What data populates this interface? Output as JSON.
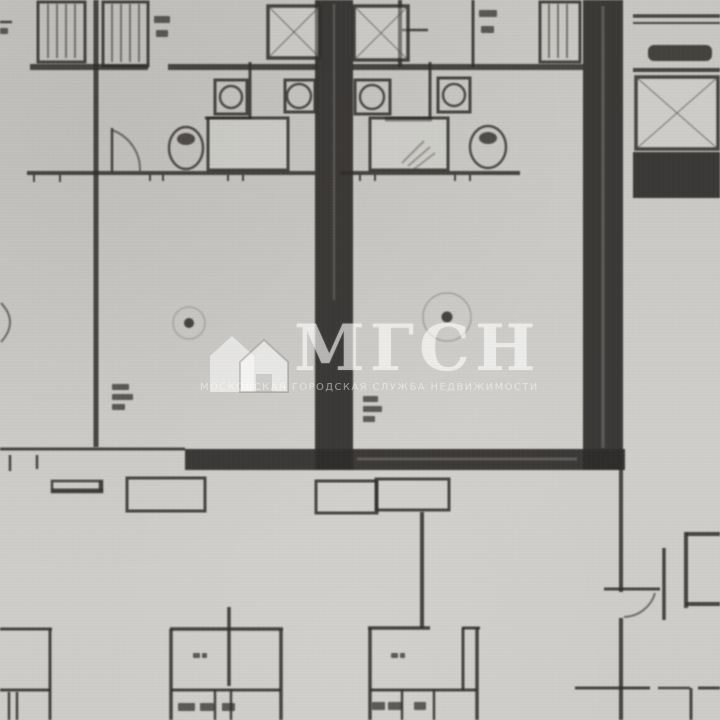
{
  "watermark": {
    "logo_text": "МГСН",
    "subtitle": "МОСКОВСКАЯ ГОРОДСКАЯ СЛУЖБА НЕДВИЖИМОСТИ",
    "color": "#ffffff",
    "opacity": 0.55,
    "icon": "house-icon"
  },
  "palette": {
    "paper": "#cbcac6",
    "paper_light": "#d6d5d1",
    "ink": "#2f2d2a",
    "ink_soft": "#45433f",
    "dark_mass": "#35332f"
  },
  "plan": {
    "thick_walls": [
      [
        315,
        0,
        38,
        470
      ],
      [
        185,
        449,
        440,
        21
      ],
      [
        583,
        0,
        40,
        470
      ],
      [
        633,
        152,
        87,
        46
      ]
    ],
    "dark_fills": [
      [
        648,
        45,
        64,
        16,
        6
      ]
    ],
    "thin_lines": [
      [
        96,
        0,
        96,
        447,
        5
      ],
      [
        250,
        62,
        250,
        118,
        3
      ],
      [
        430,
        62,
        430,
        119,
        3
      ],
      [
        400,
        0,
        400,
        67,
        4
      ],
      [
        473,
        0,
        473,
        67,
        3
      ],
      [
        422,
        512,
        422,
        628,
        4
      ],
      [
        229,
        607,
        229,
        686,
        3.5
      ],
      [
        621,
        470,
        621,
        592,
        4
      ],
      [
        621,
        618,
        621,
        720,
        4
      ],
      [
        664,
        548,
        664,
        620,
        3.5
      ],
      [
        686,
        532,
        686,
        608,
        4
      ],
      [
        50,
        629,
        50,
        720,
        3
      ],
      [
        171,
        629,
        171,
        720,
        3.5
      ],
      [
        281,
        629,
        281,
        720,
        3.5
      ],
      [
        370,
        628,
        370,
        720,
        3.5
      ],
      [
        477,
        628,
        477,
        720,
        3.5
      ],
      [
        463,
        628,
        463,
        690,
        3
      ],
      [
        402,
        690,
        402,
        720,
        2.5
      ],
      [
        434,
        690,
        434,
        720,
        2.5
      ],
      [
        215,
        690,
        215,
        720,
        2.5
      ],
      [
        231,
        690,
        231,
        720,
        2.5
      ],
      [
        9,
        692,
        9,
        720,
        2.5
      ],
      [
        17,
        692,
        17,
        720,
        2.5
      ],
      [
        691,
        688,
        691,
        720,
        3
      ],
      [
        10,
        455,
        10,
        471,
        2.5
      ],
      [
        37,
        455,
        37,
        469,
        2.5
      ],
      [
        112,
        128,
        112,
        172,
        2.5
      ],
      [
        100,
        481,
        100,
        490,
        2.5
      ],
      [
        34,
        175,
        34,
        182,
        2
      ],
      [
        60,
        175,
        60,
        182,
        2
      ],
      [
        150,
        175,
        150,
        181,
        2
      ],
      [
        163,
        175,
        163,
        181,
        2
      ],
      [
        228,
        175,
        228,
        181,
        2
      ],
      [
        243,
        175,
        243,
        181,
        2
      ],
      [
        360,
        175,
        360,
        181,
        2
      ],
      [
        375,
        175,
        375,
        181,
        2
      ],
      [
        455,
        175,
        455,
        181,
        2
      ],
      [
        470,
        175,
        470,
        181,
        2
      ],
      [
        30,
        67,
        148,
        67,
        6
      ],
      [
        168,
        67,
        318,
        67,
        6
      ],
      [
        352,
        67,
        583,
        67,
        6
      ],
      [
        27,
        173,
        315,
        173,
        4
      ],
      [
        340,
        173,
        520,
        173,
        4
      ],
      [
        205,
        118,
        252,
        118,
        3
      ],
      [
        385,
        119,
        432,
        119,
        5
      ],
      [
        0,
        449,
        185,
        449,
        3
      ],
      [
        52,
        490,
        103,
        490,
        3
      ],
      [
        0,
        629,
        52,
        629,
        3
      ],
      [
        170,
        629,
        283,
        629,
        3.5
      ],
      [
        368,
        628,
        430,
        628,
        3.5
      ],
      [
        462,
        628,
        480,
        628,
        3
      ],
      [
        0,
        690,
        50,
        690,
        3
      ],
      [
        171,
        690,
        281,
        690,
        3
      ],
      [
        370,
        690,
        477,
        690,
        3
      ],
      [
        604,
        589,
        660,
        589,
        3
      ],
      [
        575,
        688,
        650,
        688,
        3
      ],
      [
        658,
        688,
        690,
        688,
        2.5
      ],
      [
        698,
        688,
        720,
        688,
        3
      ],
      [
        686,
        534,
        720,
        534,
        4
      ],
      [
        686,
        604,
        720,
        604,
        4
      ],
      [
        633,
        16,
        720,
        16,
        3.5
      ],
      [
        633,
        23,
        720,
        23,
        2
      ],
      [
        633,
        70,
        720,
        70,
        4
      ],
      [
        402,
        30,
        428,
        30,
        2.5
      ],
      [
        0,
        22,
        12,
        22,
        2.5
      ]
    ],
    "closet_lines": [
      [
        48,
        4,
        48,
        58
      ],
      [
        57,
        4,
        57,
        58
      ],
      [
        66,
        4,
        66,
        58
      ],
      [
        75,
        4,
        75,
        58
      ],
      [
        112,
        4,
        112,
        62
      ],
      [
        121,
        4,
        121,
        62
      ],
      [
        130,
        4,
        130,
        62
      ],
      [
        139,
        4,
        139,
        62
      ],
      [
        549,
        4,
        549,
        58
      ],
      [
        558,
        4,
        558,
        58
      ],
      [
        567,
        4,
        567,
        58
      ]
    ],
    "hatch_lines": [
      [
        402,
        163,
        424,
        141
      ],
      [
        408,
        166,
        430,
        147
      ],
      [
        414,
        169,
        435,
        153
      ]
    ],
    "light_lines": [
      [
        357,
        459,
        577,
        459,
        3
      ],
      [
        603,
        6,
        603,
        448,
        3
      ],
      [
        334,
        4,
        334,
        300,
        2
      ]
    ],
    "boxes": [
      [
        38,
        2,
        47,
        60,
        3
      ],
      [
        103,
        2,
        45,
        64,
        3
      ],
      [
        540,
        2,
        40,
        60,
        3
      ],
      [
        215,
        80,
        32,
        34,
        3
      ],
      [
        285,
        80,
        30,
        32,
        3
      ],
      [
        355,
        80,
        35,
        34,
        3
      ],
      [
        438,
        78,
        32,
        34,
        3
      ],
      [
        127,
        478,
        78,
        33,
        3
      ],
      [
        52,
        481,
        50,
        11,
        2.5
      ],
      [
        316,
        481,
        61,
        32,
        3
      ],
      [
        376,
        479,
        73,
        31,
        3
      ]
    ],
    "light_boxes": [
      [
        208,
        118,
        80,
        52
      ],
      [
        370,
        118,
        78,
        52
      ]
    ],
    "shafts": [
      [
        268,
        6,
        52,
        52
      ],
      [
        354,
        6,
        54,
        54
      ],
      [
        636,
        77,
        82,
        72
      ]
    ],
    "circles": [
      [
        231,
        97,
        11,
        2.5
      ],
      [
        299,
        96,
        12,
        2.5
      ],
      [
        372,
        97,
        12,
        2.5
      ],
      [
        454,
        95,
        11,
        2.5
      ]
    ],
    "ellipses": [
      [
        186,
        148,
        17,
        21
      ],
      [
        488,
        147,
        18,
        21
      ]
    ],
    "blobs": [
      [
        186,
        139,
        9,
        6
      ],
      [
        488,
        138,
        9,
        6
      ]
    ],
    "dots": [
      [
        189,
        323,
        5
      ],
      [
        447,
        317,
        5.5
      ]
    ],
    "rings": [
      [
        189,
        323,
        16,
        0.25
      ],
      [
        447,
        317,
        24,
        0.3
      ]
    ],
    "arcs": [
      "M 1 303 Q 19 322 1 342",
      "M 112 130 A 42 42 0 0 1 140 171",
      "M 624 617 A 33 33 0 0 0 655 593"
    ],
    "marks": [
      [
        154,
        16,
        16,
        7
      ],
      [
        156,
        30,
        12,
        7
      ],
      [
        479,
        10,
        18,
        7
      ],
      [
        481,
        26,
        13,
        7
      ],
      [
        0,
        28,
        8,
        6
      ],
      [
        112,
        384,
        17,
        6
      ],
      [
        112,
        394,
        21,
        6
      ],
      [
        112,
        404,
        13,
        6
      ],
      [
        363,
        396,
        15,
        6
      ],
      [
        363,
        406,
        19,
        6
      ],
      [
        363,
        416,
        12,
        6
      ],
      [
        193,
        653,
        7,
        5
      ],
      [
        202,
        653,
        5,
        5
      ],
      [
        391,
        653,
        7,
        5
      ],
      [
        400,
        653,
        5,
        5
      ],
      [
        178,
        703,
        17,
        8
      ],
      [
        200,
        703,
        14,
        8
      ],
      [
        222,
        703,
        13,
        8
      ],
      [
        372,
        702,
        13,
        8
      ],
      [
        388,
        702,
        14,
        8
      ],
      [
        414,
        702,
        12,
        8
      ]
    ]
  }
}
